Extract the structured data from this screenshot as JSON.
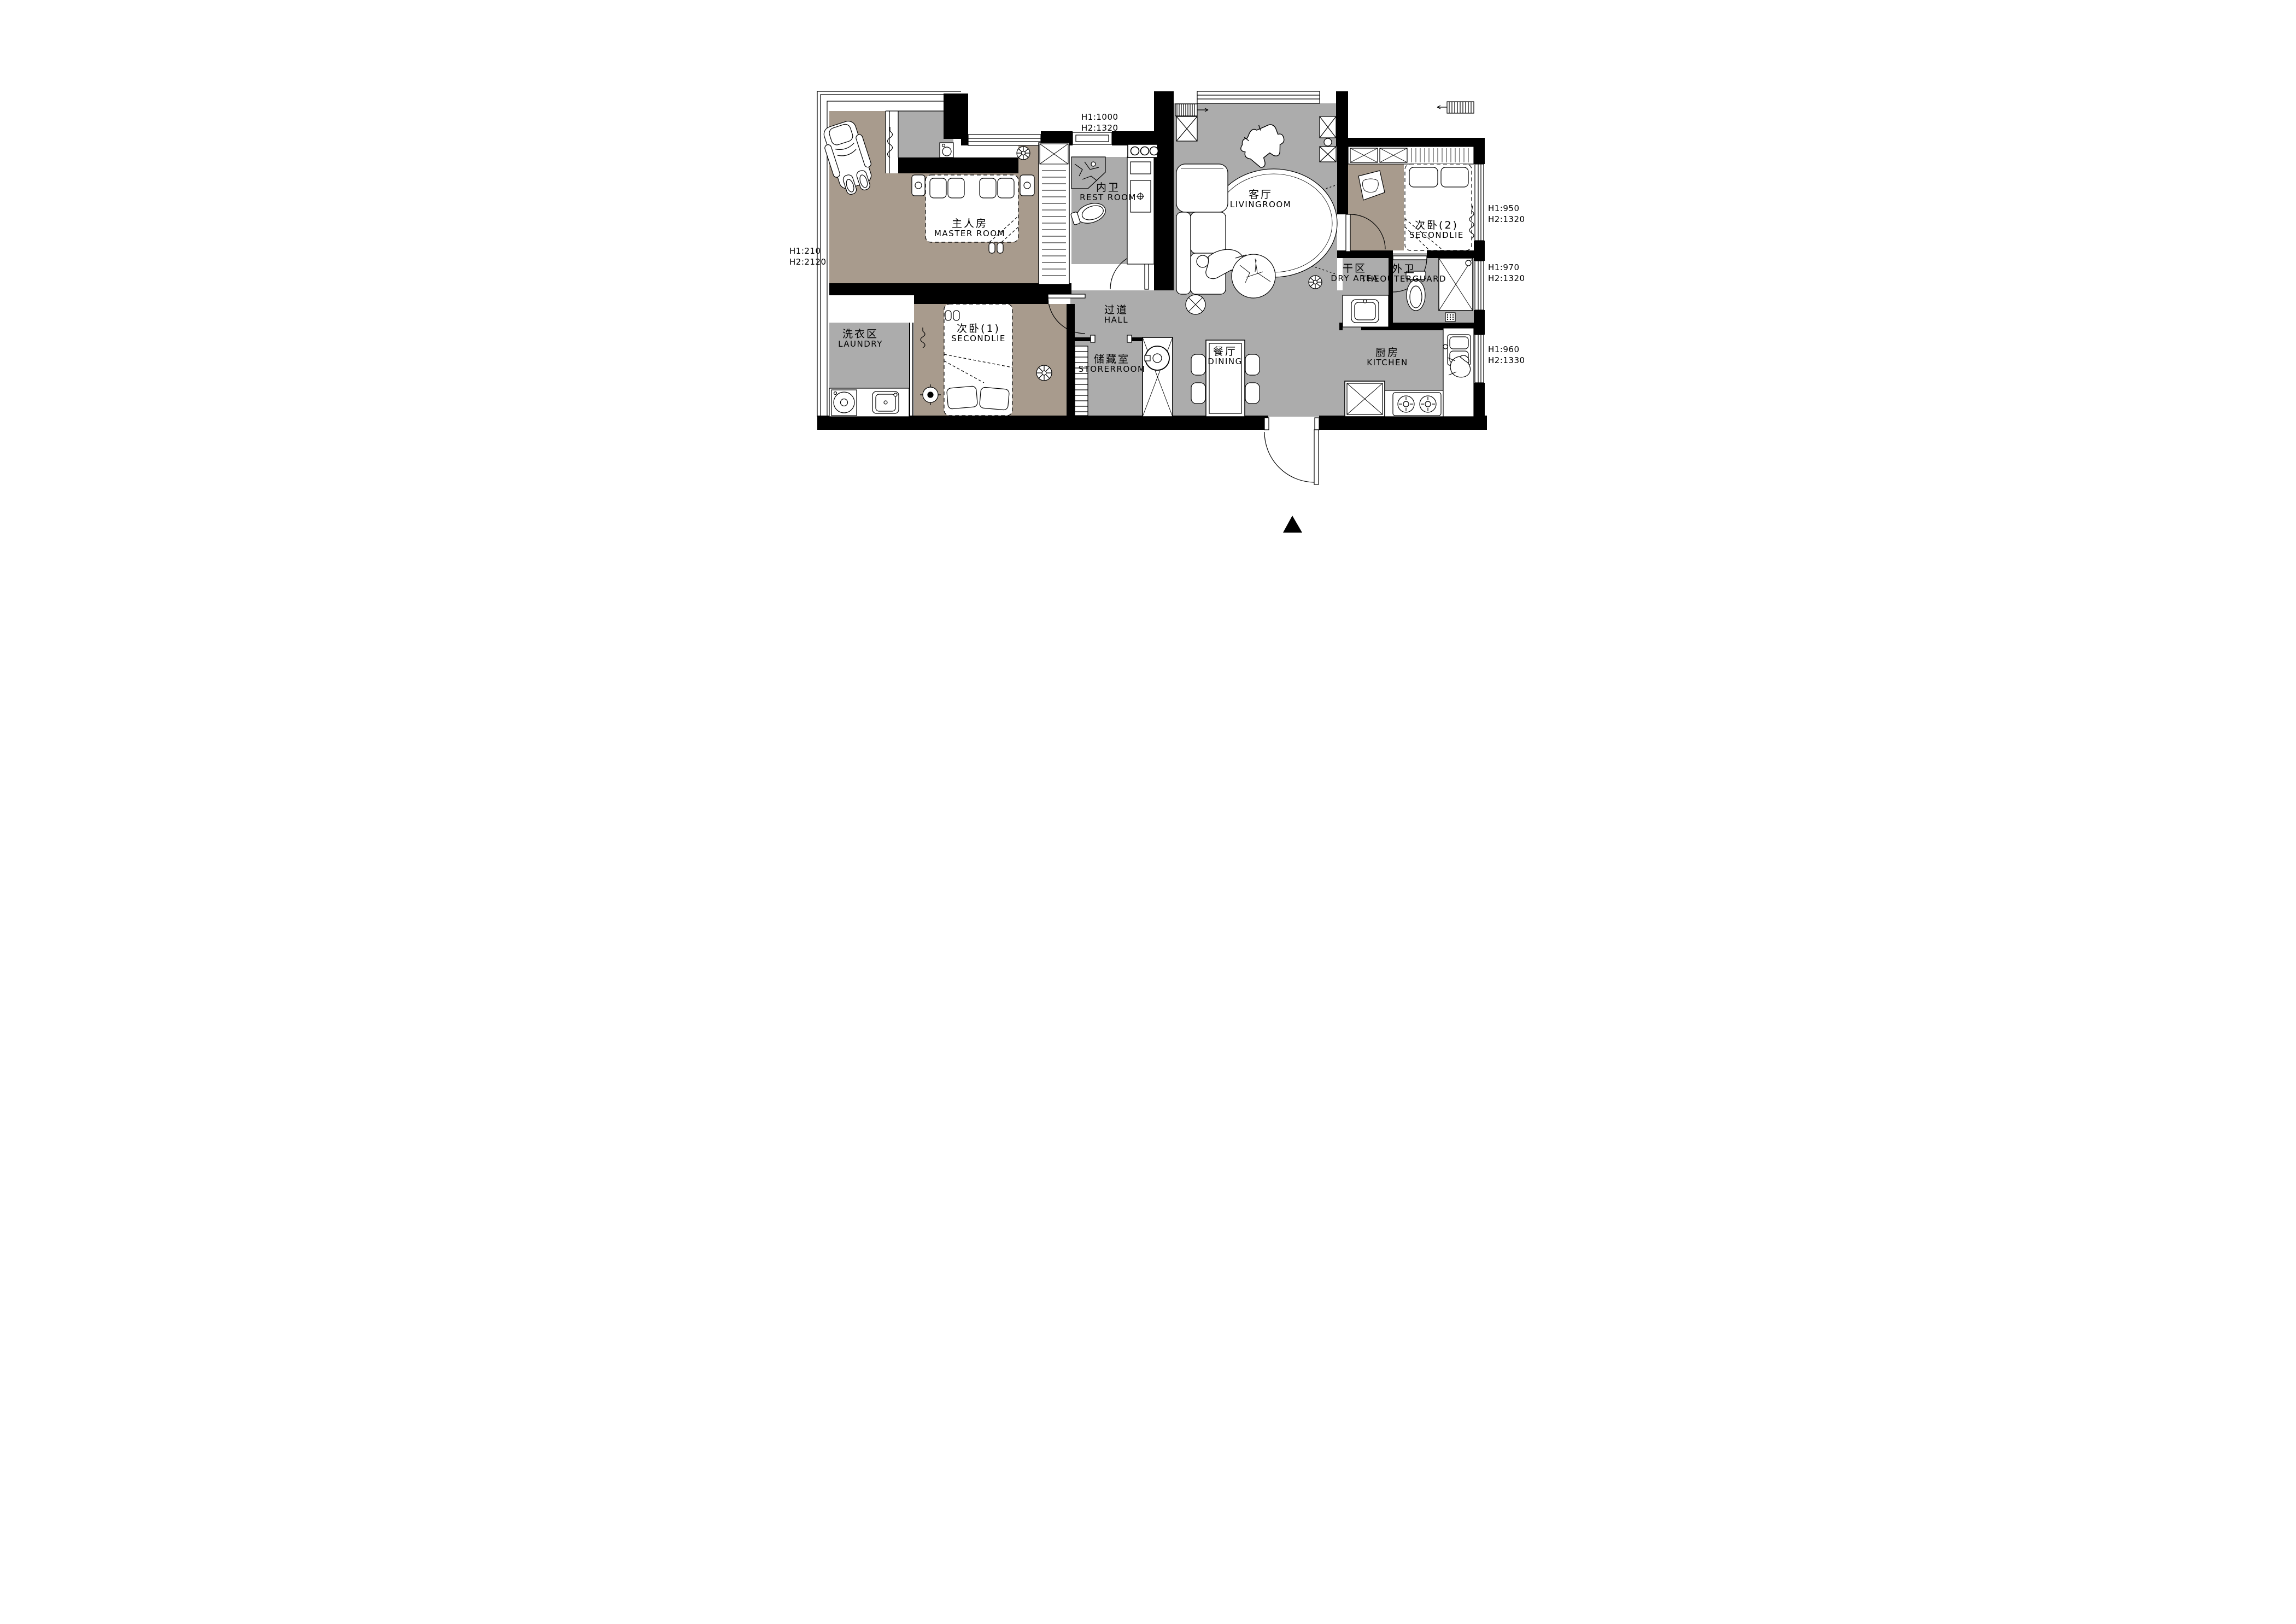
{
  "colors": {
    "wall": "#000000",
    "floor_public_gray": "#ACACAC",
    "floor_bedroom_taupe": "#A89B8D",
    "line": "#000000",
    "paper": "#ffffff"
  },
  "plan": {
    "rooms": [
      {
        "key": "master-room",
        "zh": "主人房",
        "en": "MASTER ROOM"
      },
      {
        "key": "rest-room",
        "zh": "内卫",
        "en": "REST ROOM"
      },
      {
        "key": "living-room",
        "zh": "客厅",
        "en": "LIVINGROOM"
      },
      {
        "key": "second-bedroom-2",
        "zh": "次卧(2)",
        "en": "SECONDLIE"
      },
      {
        "key": "dry-area",
        "zh": "干区",
        "en": "DRY AREA"
      },
      {
        "key": "outer-bathroom",
        "zh": "外卫",
        "en": "THEOUTERGUARD"
      },
      {
        "key": "laundry",
        "zh": "洗衣区",
        "en": "LAUNDRY"
      },
      {
        "key": "second-bedroom-1",
        "zh": "次卧(1)",
        "en": "SECONDLIE"
      },
      {
        "key": "hall",
        "zh": "过道",
        "en": "HALL"
      },
      {
        "key": "storeroom",
        "zh": "储藏室",
        "en": "STORERROOM"
      },
      {
        "key": "dining",
        "zh": "餐厅",
        "en": "DINING"
      },
      {
        "key": "kitchen",
        "zh": "厨房",
        "en": "KITCHEN"
      }
    ],
    "window_dimensions": [
      {
        "key": "top",
        "h1": "H1:1000",
        "h2": "H2:1320"
      },
      {
        "key": "left",
        "h1": "H1:210",
        "h2": "H2:2120"
      },
      {
        "key": "right-top",
        "h1": "H1:950",
        "h2": "H2:1320"
      },
      {
        "key": "right-middle",
        "h1": "H1:970",
        "h2": "H2:1320"
      },
      {
        "key": "right-bottom",
        "h1": "H1:960",
        "h2": "H2:1330"
      }
    ]
  }
}
